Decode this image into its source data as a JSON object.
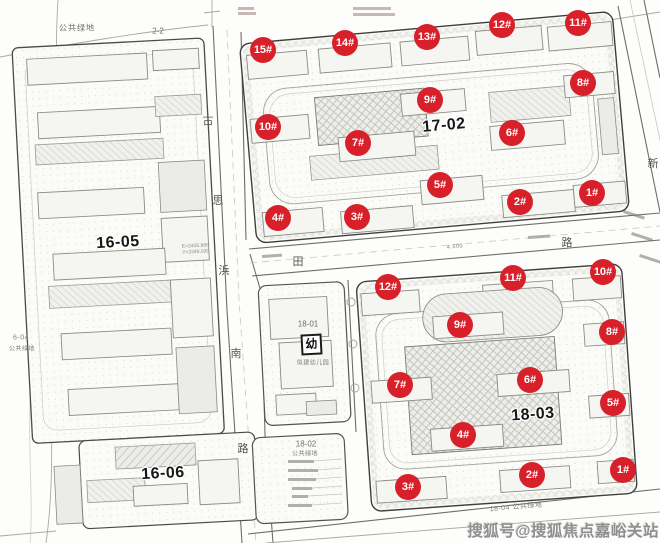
{
  "colors": {
    "marker": "#d8202a",
    "bold_label": "#171717",
    "watermark": "#8f8f8f",
    "line": "#6e6e68"
  },
  "labels": {
    "parcel_16_05": "16-05",
    "parcel_16_06": "16-06",
    "parcel_17_02": "17-02",
    "parcel_18_03": "18-03",
    "parcel_18_01": "18-01",
    "parcel_18_02": "18-02",
    "green_top": "公共绿地",
    "green_18_02": "公共绿地",
    "green_18_04": "18-04 公共绿地",
    "green_6_04_line1": "6-04",
    "green_6_04_line2": "公共绿地",
    "section_mark": "2-2",
    "kindergarten_symbol": "幼",
    "kindergarten_note": "拟建幼儿园",
    "coord_line1": "E=2405.988",
    "coord_line2": "Y=2349.030",
    "dim_4500": "4.500"
  },
  "roads": {
    "west_road": {
      "name": "古思浜南路",
      "chars": [
        {
          "ch": "古",
          "x": 208,
          "y": 120
        },
        {
          "ch": "思",
          "x": 218,
          "y": 200
        },
        {
          "ch": "浜",
          "x": 224,
          "y": 270
        },
        {
          "ch": "南",
          "x": 236,
          "y": 353
        },
        {
          "ch": "路",
          "x": 243,
          "y": 448
        }
      ]
    },
    "middle_road": {
      "name": "田路",
      "chars": [
        {
          "ch": "田",
          "x": 298,
          "y": 261
        },
        {
          "ch": "路",
          "x": 567,
          "y": 242
        }
      ]
    },
    "east_road": {
      "name": "新",
      "chars": [
        {
          "ch": "新",
          "x": 653,
          "y": 163
        }
      ]
    }
  },
  "markers_17_02": [
    {
      "label": "1#",
      "x": 592,
      "y": 193
    },
    {
      "label": "2#",
      "x": 520,
      "y": 202
    },
    {
      "label": "3#",
      "x": 357,
      "y": 217
    },
    {
      "label": "4#",
      "x": 278,
      "y": 218
    },
    {
      "label": "5#",
      "x": 440,
      "y": 185
    },
    {
      "label": "6#",
      "x": 512,
      "y": 133
    },
    {
      "label": "7#",
      "x": 358,
      "y": 143
    },
    {
      "label": "8#",
      "x": 583,
      "y": 83
    },
    {
      "label": "9#",
      "x": 430,
      "y": 100
    },
    {
      "label": "10#",
      "x": 268,
      "y": 127
    },
    {
      "label": "11#",
      "x": 578,
      "y": 23
    },
    {
      "label": "12#",
      "x": 502,
      "y": 25
    },
    {
      "label": "13#",
      "x": 427,
      "y": 37
    },
    {
      "label": "14#",
      "x": 345,
      "y": 43
    },
    {
      "label": "15#",
      "x": 263,
      "y": 50
    }
  ],
  "markers_18_03": [
    {
      "label": "1#",
      "x": 623,
      "y": 470
    },
    {
      "label": "2#",
      "x": 532,
      "y": 475
    },
    {
      "label": "3#",
      "x": 408,
      "y": 487
    },
    {
      "label": "4#",
      "x": 463,
      "y": 435
    },
    {
      "label": "5#",
      "x": 613,
      "y": 403
    },
    {
      "label": "6#",
      "x": 530,
      "y": 380
    },
    {
      "label": "7#",
      "x": 400,
      "y": 385
    },
    {
      "label": "8#",
      "x": 612,
      "y": 332
    },
    {
      "label": "9#",
      "x": 460,
      "y": 325
    },
    {
      "label": "10#",
      "x": 603,
      "y": 272
    },
    {
      "label": "11#",
      "x": 513,
      "y": 278
    },
    {
      "label": "12#",
      "x": 388,
      "y": 287
    }
  ],
  "watermark": {
    "text": "搜狐号@搜狐焦点嘉峪关站"
  }
}
